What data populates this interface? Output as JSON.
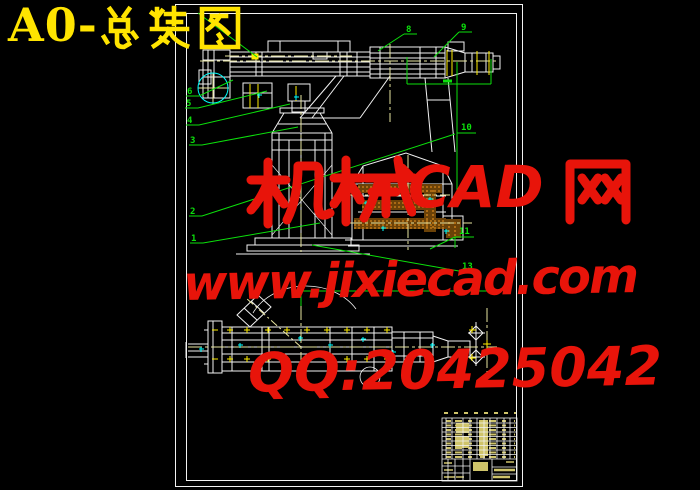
{
  "page": {
    "background_color": "#000000"
  },
  "title": {
    "full_text": "A0-总装图",
    "latin": "A0-",
    "cjk": "总装图",
    "color": "#ffe400"
  },
  "watermark": {
    "color": "#e8140a",
    "line1": {
      "full_text": "机械CAD网",
      "cjk_left": "机械",
      "latin_mid": "CAD",
      "cjk_right": "网"
    },
    "line2": "www.jixiecad.com",
    "line3": "QQ:20425042"
  },
  "drawing": {
    "frame_color": "#f2f2f2",
    "colors": {
      "geometry_white": "#f2f2f2",
      "centerline_yellow": "#e9e6a0",
      "bolt_yellow": "#ffee00",
      "annotation_green": "#0ce00c",
      "detail_cyan": "#00ffff",
      "hatch_orange": "#c07818",
      "titleblock_text_yellow": "#cfc46a"
    },
    "balloons": [
      {
        "label": "6",
        "x": 187,
        "y": 88
      },
      {
        "label": "5",
        "x": 186,
        "y": 100
      },
      {
        "label": "4",
        "x": 187,
        "y": 117
      },
      {
        "label": "3",
        "x": 190,
        "y": 137
      },
      {
        "label": "2",
        "x": 190,
        "y": 208
      },
      {
        "label": "1",
        "x": 191,
        "y": 235
      },
      {
        "label": "8",
        "x": 406,
        "y": 26
      },
      {
        "label": "9",
        "x": 461,
        "y": 24
      },
      {
        "label": "10",
        "x": 461,
        "y": 124
      },
      {
        "label": "11",
        "x": 459,
        "y": 228
      },
      {
        "label": "13",
        "x": 462,
        "y": 263
      }
    ]
  }
}
